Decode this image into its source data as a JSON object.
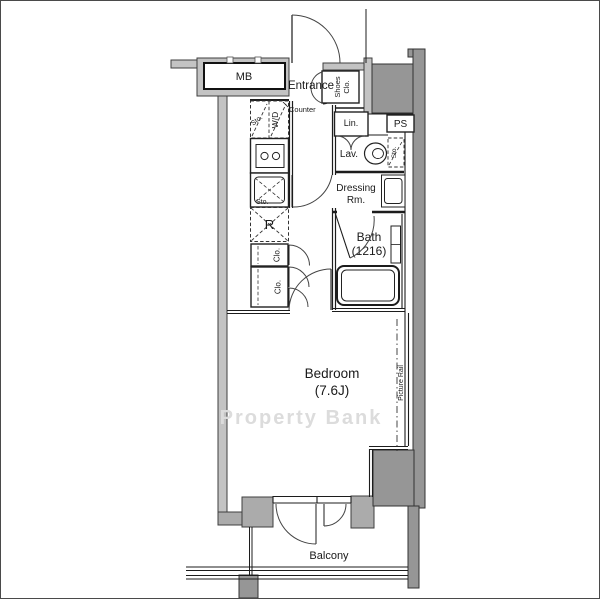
{
  "page": {
    "title_hint": "apartment floor plan",
    "watermark": "Property Bank"
  },
  "colors": {
    "background": "#ffffff",
    "wall_light": "#c3c3c3",
    "wall_dark": "#969696",
    "line": "#1c1c1c",
    "watermark_gray": "#dcdcdc"
  },
  "rooms": {
    "meter_box": "MB",
    "entrance": "Entrance",
    "shoes_closet_line1": "Shoes",
    "shoes_closet_line2": "Clo.",
    "counter": "Counter",
    "storage_top": "Sto.",
    "washer_dryer": "W/D",
    "sink_storage": "Sto.",
    "refrigerator": "R",
    "closet_1": "Clo.",
    "closet_2": "Clo.",
    "linen": "Lin.",
    "pipe_space": "PS",
    "lavatory": "Lav.",
    "lavatory_storage": "Sto.",
    "dressing_line1": "Dressing",
    "dressing_line2": "Rm.",
    "bath": "Bath",
    "bath_size": "(1216)",
    "bedroom": "Bedroom",
    "bedroom_size": "(7.6J)",
    "picture_rail": "Picture Rail",
    "balcony": "Balcony"
  }
}
